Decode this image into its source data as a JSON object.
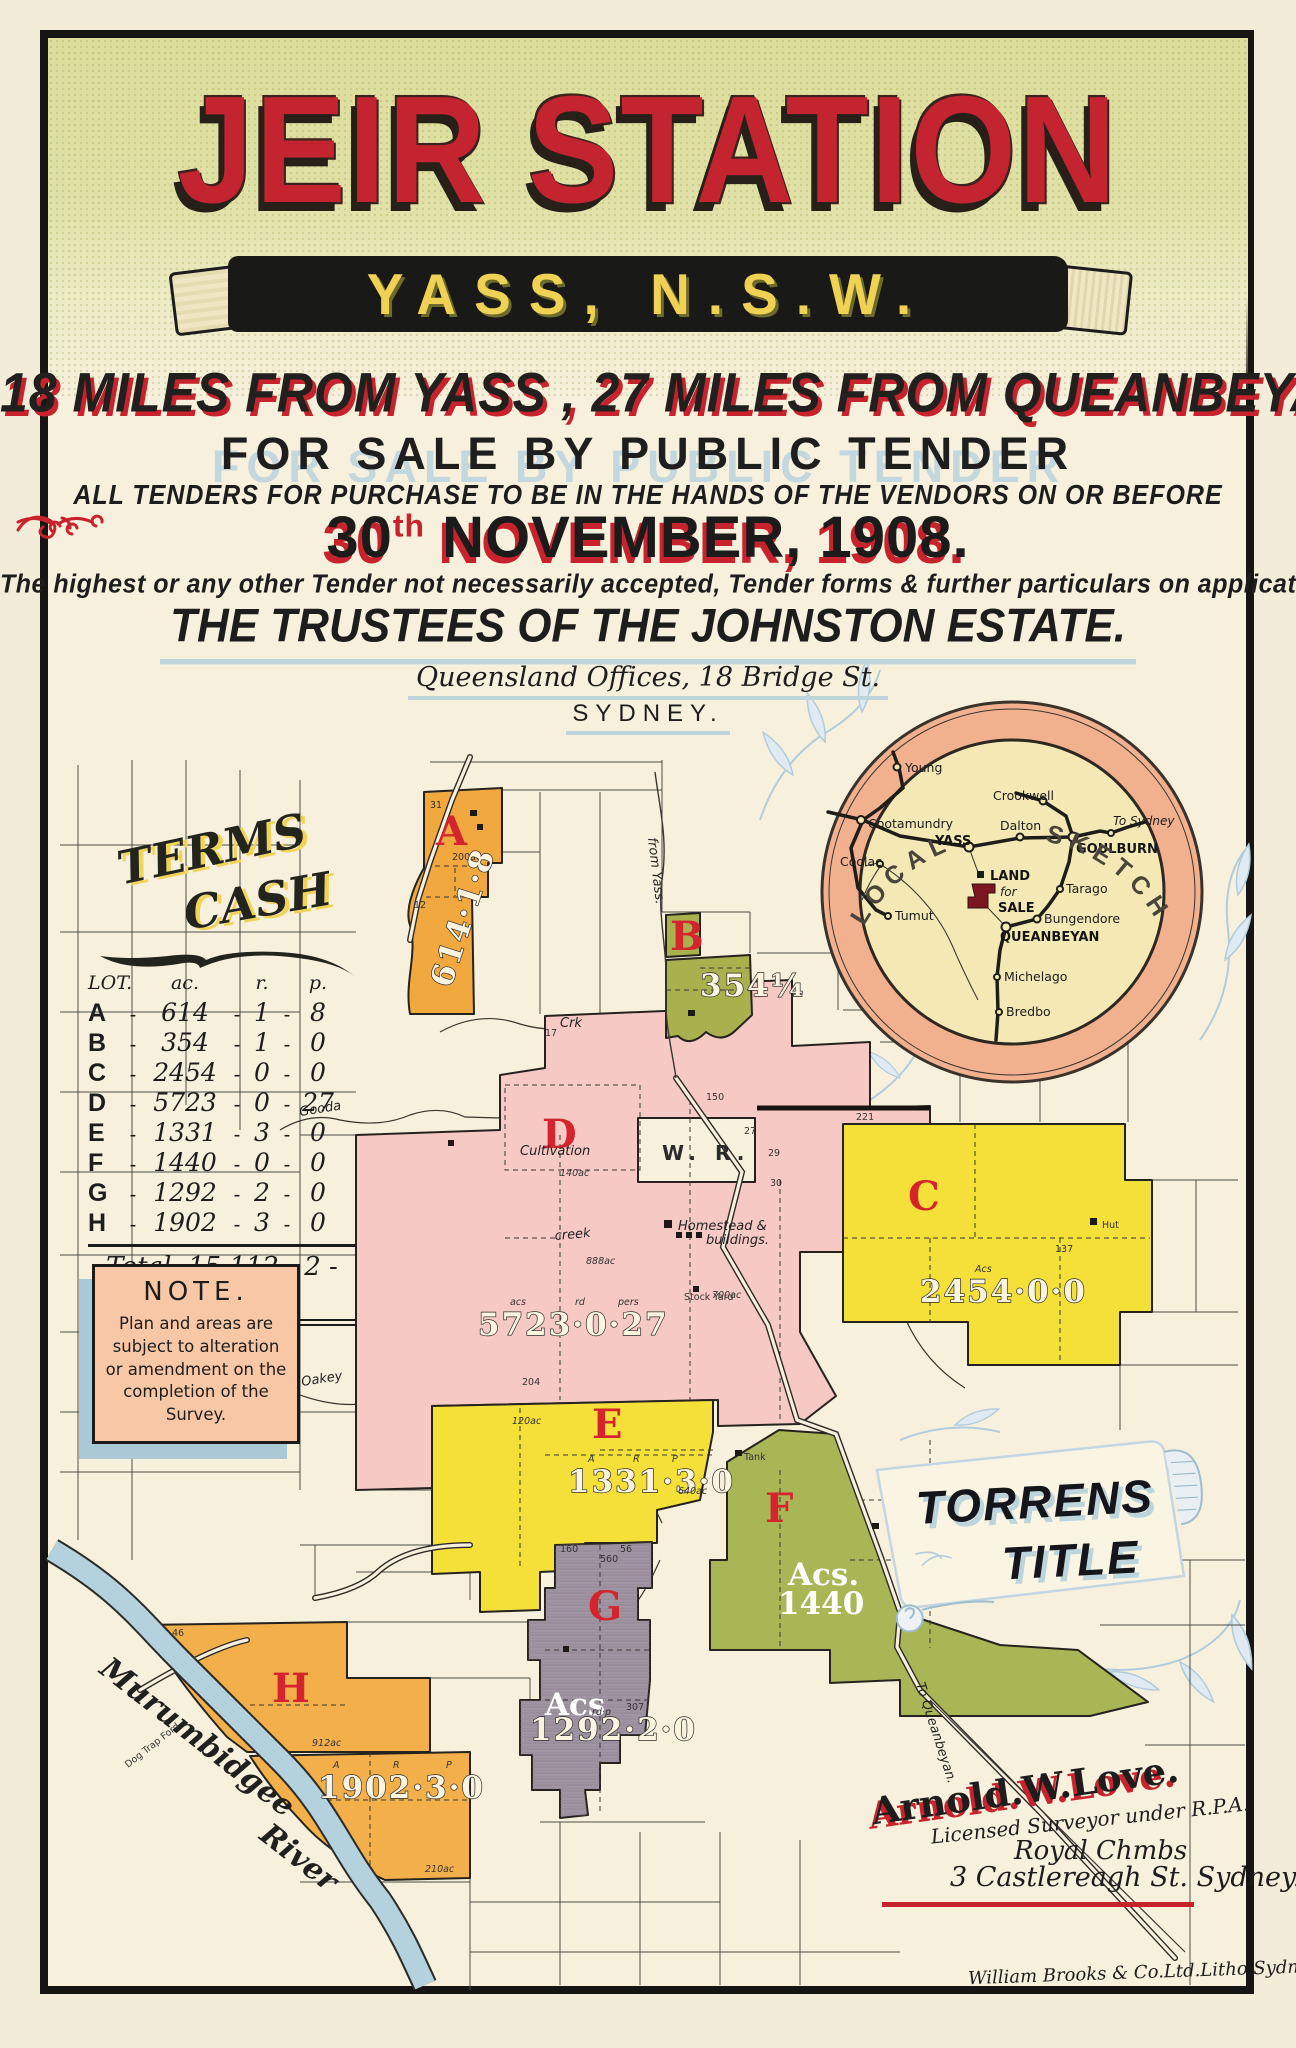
{
  "poster": {
    "title": "JEIR STATION",
    "banner": "YASS, N.S.W.",
    "line_miles": "18 MILES FROM YASS , 27 MILES FROM QUEANBEYAN.",
    "line_sale": "FOR SALE BY PUBLIC TENDER",
    "line_tenders": "ALL TENDERS FOR PURCHASE TO BE IN THE HANDS OF THE VENDORS ON OR BEFORE",
    "date_day": "30",
    "date_suffix": "th",
    "date_rest": " NOVEMBER, 1908.",
    "line_highest": "The highest or any other Tender not necessarily accepted, Tender forms & further particulars on application to vendors",
    "trustees": "THE TRUSTEES OF THE JOHNSTON ESTATE.",
    "address1": "Queensland Offices, 18 Bridge St.",
    "address2": "SYDNEY."
  },
  "terms": {
    "heading1": "TERMS",
    "heading2": "CASH",
    "col_lot": "LOT.",
    "col_ac": "ac.",
    "col_r": "r.",
    "col_p": "p.",
    "dash": "-",
    "lots": [
      {
        "lot": "A",
        "ac": "614",
        "r": "1",
        "p": "8"
      },
      {
        "lot": "B",
        "ac": "354",
        "r": "1",
        "p": "0"
      },
      {
        "lot": "C",
        "ac": "2454",
        "r": "0",
        "p": "0"
      },
      {
        "lot": "D",
        "ac": "5723",
        "r": "0",
        "p": "27"
      },
      {
        "lot": "E",
        "ac": "1331",
        "r": "3",
        "p": "0"
      },
      {
        "lot": "F",
        "ac": "1440",
        "r": "0",
        "p": "0"
      },
      {
        "lot": "G",
        "ac": "1292",
        "r": "2",
        "p": "0"
      },
      {
        "lot": "H",
        "ac": "1902",
        "r": "3",
        "p": "0"
      }
    ],
    "total_label": "Total,",
    "total_value": "15,112 - 2 - 35"
  },
  "note": {
    "heading": "NOTE.",
    "body": "Plan and areas are subject to alteration or amendment on the completion of the Survey."
  },
  "sketch": {
    "ring_left": "LOCAL",
    "ring_right": "SKETCH",
    "land1": "LAND",
    "land2": "for",
    "land3": "SALE",
    "towns": [
      {
        "name": "Young"
      },
      {
        "name": "Crookwell"
      },
      {
        "name": "Cootamundry"
      },
      {
        "name": "Dalton"
      },
      {
        "name": "YASS"
      },
      {
        "name": "GOULBURN"
      },
      {
        "name": "To Sydney"
      },
      {
        "name": "Coolac"
      },
      {
        "name": "Tarago"
      },
      {
        "name": "Bungendore"
      },
      {
        "name": "QUEANBEYAN"
      },
      {
        "name": "Tumut"
      },
      {
        "name": "Michelago"
      },
      {
        "name": "Bredbo"
      }
    ]
  },
  "torrens": {
    "line1": "TORRENS",
    "line2": "TITLE"
  },
  "map": {
    "labels": {
      "wr": "W. R.",
      "cultivation": "Cultivation",
      "homestead1": "Homestead &",
      "homestead2": "buildings.",
      "creek": "creek",
      "crk": "Crk",
      "gooda": "Gooda",
      "oakey": "Oakey",
      "from_yass": "from Yass.",
      "to_queanbeyan": "To Queanbeyan.",
      "river1": "Murumbidgee",
      "river2": "River",
      "dog_trap": "Dog Trap Ford",
      "hut": "Hut",
      "tank": "Tank",
      "stock_yard": "Stock Yard"
    },
    "lots": {
      "a": {
        "letter": "A",
        "area": "614·1·8",
        "sub": "200ac"
      },
      "b": {
        "letter": "B",
        "area": "354¼"
      },
      "c": {
        "letter": "C",
        "acs": "Acs",
        "area": "2454·0·0"
      },
      "d": {
        "letter": "D",
        "area": "5723·0·27",
        "col1": "acs",
        "col2": "rd",
        "col3": "pers"
      },
      "e": {
        "letter": "E",
        "area": "1331·3·0",
        "col1": "A",
        "col2": "R",
        "col3": "P"
      },
      "f": {
        "letter": "F",
        "acs": "Acs.",
        "area": "1440"
      },
      "g": {
        "letter": "G",
        "acs": "Acs",
        "area": "1292·2·0",
        "col": "rd·p"
      },
      "h": {
        "letter": "H",
        "area": "1902·3·0",
        "col1": "A",
        "col2": "R",
        "col3": "P"
      }
    },
    "parcels": [
      "31",
      "12",
      "150",
      "221",
      "27",
      "29",
      "30",
      "17",
      "204",
      "56",
      "640ac",
      "46",
      "912ac",
      "210ac",
      "160",
      "307",
      "137",
      "140ac",
      "120ac",
      "888ac",
      "700ac",
      "560"
    ]
  },
  "surveyor": {
    "name": "Arnold.W.Love.",
    "line1": "Licensed Surveyor under R.P.A.",
    "line2": "Royal Chmbs",
    "line3": "3 Castlereagh St. Sydney."
  },
  "printer": {
    "credit": "William Brooks & Co.Ltd.Litho,Sydney."
  },
  "colors": {
    "accent_red": "#c8222c",
    "title_red": "#c32430",
    "banner_yellow": "#efd254",
    "shadow_blue": "#bdd5db",
    "lot_orange": "#f1a83e",
    "lot_olive": "#a9b14f",
    "lot_yellow": "#f4e039",
    "lot_pink": "#f7c9c4",
    "lot_grey": "#a094a2",
    "river_blue": "#b3d2de",
    "sketch_ring": "#f2b18e",
    "sketch_inner": "#f4e9b5",
    "note_bg": "#f8c7a5",
    "header_green": "#dcdd9b"
  }
}
